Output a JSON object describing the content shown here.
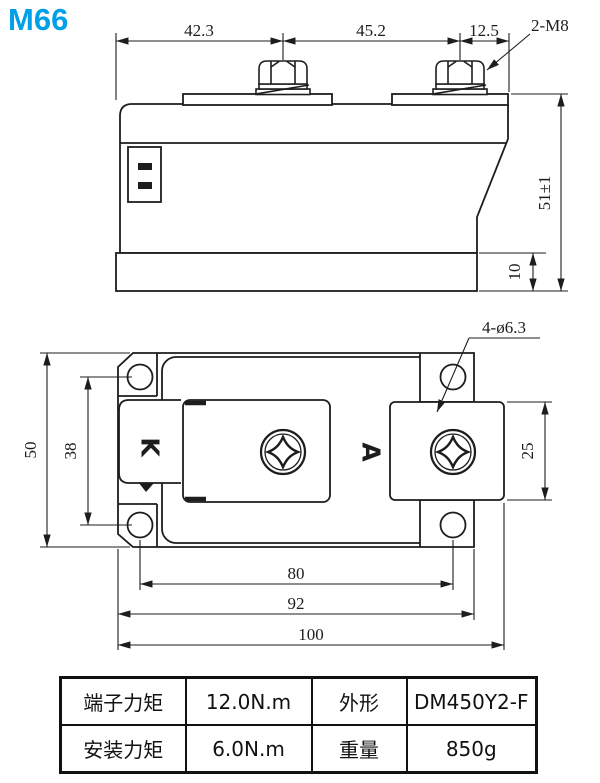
{
  "title": "M66",
  "accent_color": "#00a0e9",
  "line_color": "#1d1d1d",
  "side_view": {
    "dim_left": "42.3",
    "dim_center": "45.2",
    "dim_right": "12.5",
    "bolt_callout": "2-M8",
    "dim_height": "51±1",
    "dim_base_thickness": "10"
  },
  "plan_view": {
    "hole_callout": "4-ø6.3",
    "terminal_cathode": "K",
    "terminal_anode": "A",
    "dim_width": "50",
    "dim_hole_span_vertical": "38",
    "dim_pad_width": "25",
    "dim_hole_span_horizontal": "80",
    "dim_body_length": "92",
    "dim_total_length": "100"
  },
  "spec_table": {
    "terminal_torque_label": "端子力矩",
    "terminal_torque_value": "12.0N.m",
    "outline_label": "外形",
    "outline_value": "DM450Y2-F",
    "mounting_torque_label": "安装力矩",
    "mounting_torque_value": "6.0N.m",
    "weight_label": "重量",
    "weight_value": "850g"
  }
}
